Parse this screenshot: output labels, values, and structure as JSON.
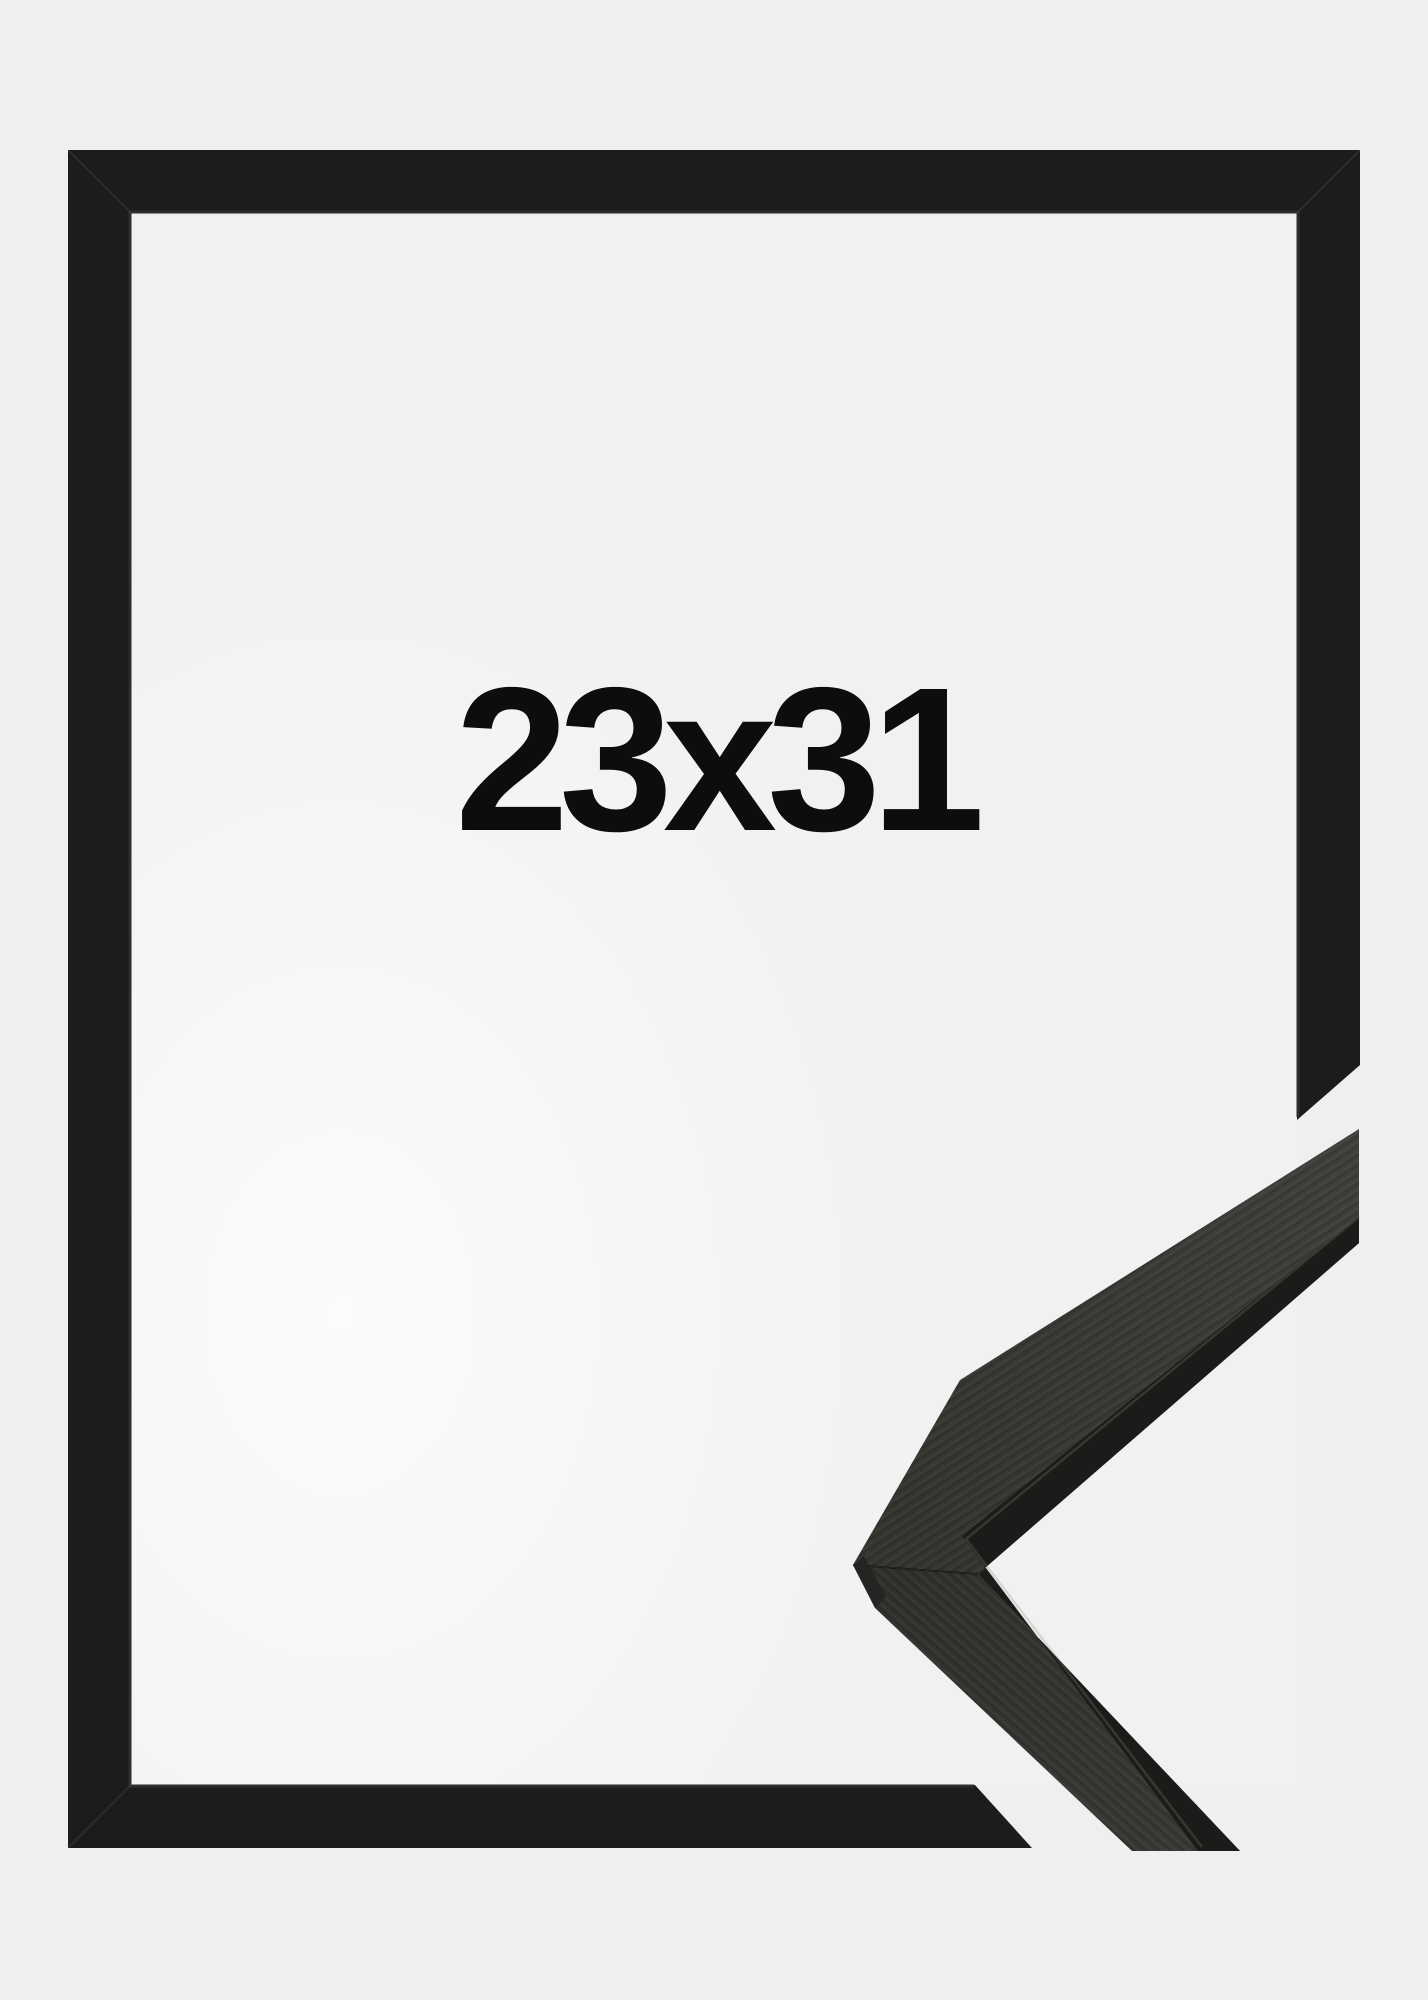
{
  "product_image": {
    "size_label": "23x31",
    "description_names": {
      "main_shape": "black-picture-frame-front",
      "detail_shape": "frame-moulding-corner-sample"
    },
    "colors": {
      "bg": "#efefef",
      "interior_edge": "#fbfbfb",
      "interior_center": "#f1f1f1",
      "frame_black": "#1c1c1c",
      "frame_lip_highlight": "#2d2d2c",
      "sample_surface_light": "#403f3b",
      "sample_surface_dark": "#31302d",
      "sample_profile_edge": "#1b1b1a",
      "sample_highlight_line": "#8a8878",
      "label_text": "#0d0d0d"
    }
  }
}
